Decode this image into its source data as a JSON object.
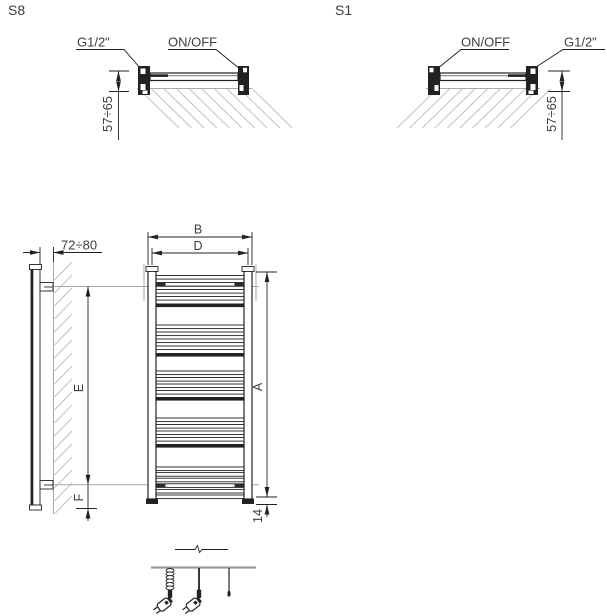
{
  "title_left": "S8",
  "title_right": "S1",
  "s8": {
    "connection": "G1/2\"",
    "switch": "ON/OFF",
    "wall_to_axis": "57÷65"
  },
  "s1": {
    "switch": "ON/OFF",
    "connection": "G1/2\"",
    "wall_to_axis": "57÷65"
  },
  "side_view": {
    "wall_clearance": "72÷80",
    "mount_span": "E",
    "mount_bottom": "F"
  },
  "front_view": {
    "width_overall": "B",
    "width_axes": "D",
    "height": "A",
    "bottom_offset": "14"
  },
  "colors": {
    "ink": "#222222",
    "reference_gray": "#a8a8a8",
    "hatch_gray": "#c2c2c2",
    "text": "#3d3d3d"
  }
}
